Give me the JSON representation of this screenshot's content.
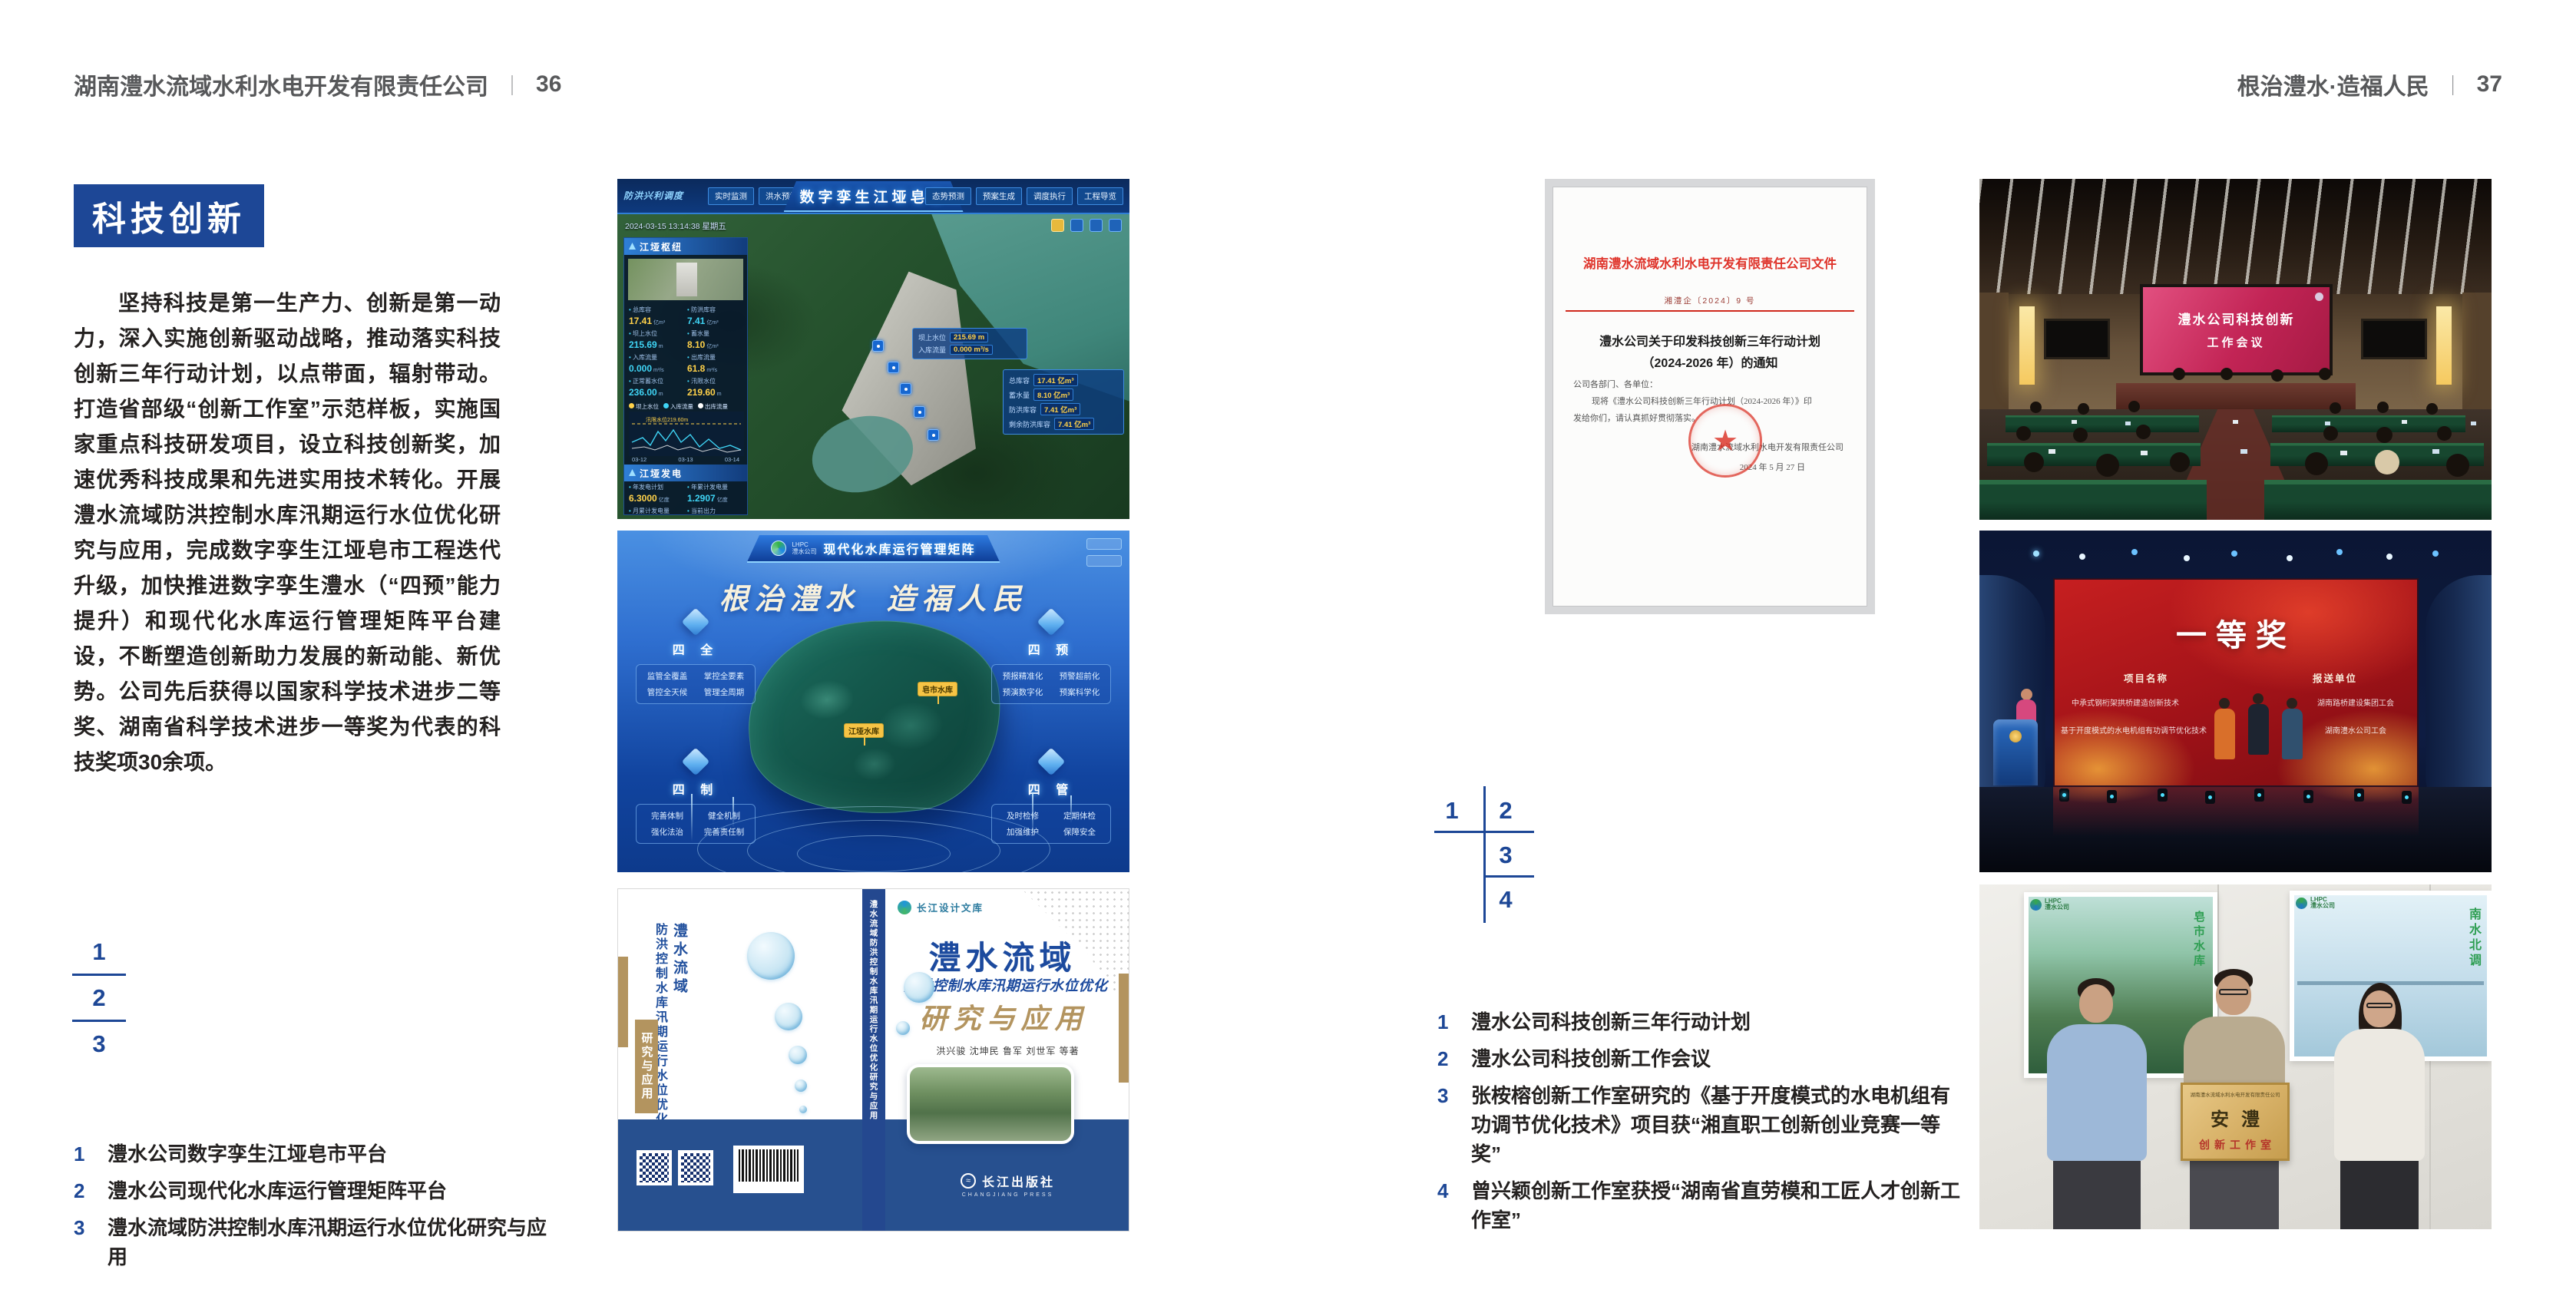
{
  "colors": {
    "accent_blue": "#1d4796",
    "text_dark": "#242120",
    "header_gray": "#57585a",
    "doc_red": "#df342b",
    "tan": "#b3945f"
  },
  "left_page": {
    "header_company": "湖南澧水流域水利水电开发有限责任公司",
    "header_sep": "｜",
    "header_page": "36",
    "section_title": "科技创新",
    "body_text": "坚持科技是第一生产力、创新是第一动力，深入实施创新驱动战略，推动落实科技创新三年行动计划，以点带面，辐射带动。打造省部级“创新工作室”示范样板，实施国家重点科技研发项目，设立科技创新奖，加速优秀科技成果和先进实用技术转化。开展澧水流域防洪控制水库汛期运行水位优化研究与应用，完成数字孪生江垭皂市工程迭代升级，加快推进数字孪生澧水（“四预”能力提升）和现代化水库运行管理矩阵平台建设，不断塑造创新助力发展的新动能、新优势。公司先后获得以国家科学技术进步二等奖、湖南省科学技术进步一等奖为代表的科技奖项30余项。",
    "key_numbers": [
      "1",
      "2",
      "3"
    ],
    "captions": [
      {
        "no": "1",
        "text": "澧水公司数字孪生江垭皂市平台"
      },
      {
        "no": "2",
        "text": "澧水公司现代化水库运行管理矩阵平台"
      },
      {
        "no": "3",
        "text": "澧水流域防洪控制水库汛期运行水位优化研究与应用"
      }
    ]
  },
  "right_page": {
    "header_slogan": "根治澧水·造福人民",
    "header_sep": "｜",
    "header_page": "37",
    "key_numbers": [
      "1",
      "2",
      "3",
      "4"
    ],
    "captions": [
      {
        "no": "1",
        "text": "澧水公司科技创新三年行动计划"
      },
      {
        "no": "2",
        "text": "澧水公司科技创新工作会议"
      },
      {
        "no": "3",
        "text": "张桉榕创新工作室研究的《基于开度模式的水电机组有功调节优化技术》项目获“湘直职工创新创业竞赛一等奖”"
      },
      {
        "no": "4",
        "text": "曾兴颖创新工作室获授“湖南省直劳模和工匠人才创新工作室”"
      }
    ]
  },
  "dashboard": {
    "title": "数字孪生江垭皂市",
    "corner_tab": "防洪兴利调度",
    "tabs_left": [
      "实时监测",
      "洪水预报",
      "防洪预警"
    ],
    "tabs_right": [
      "态势预测",
      "预案生成",
      "调度执行",
      "工程导览"
    ],
    "timestamp": "2024-03-15 13:14:38 星期五",
    "hub_panel_title": "江垭枢纽",
    "stats": [
      {
        "label": "总库容",
        "value": "17.41",
        "unit": "亿m³"
      },
      {
        "label": "防洪库容",
        "value": "7.41",
        "unit": "亿m³"
      },
      {
        "label": "坝上水位",
        "value": "215.69",
        "unit": "m"
      },
      {
        "label": "蓄水量",
        "value": "8.10",
        "unit": "亿m³"
      },
      {
        "label": "入库流量",
        "value": "0.000",
        "unit": "m³/s"
      },
      {
        "label": "出库流量",
        "value": "61.8",
        "unit": "m³/s"
      },
      {
        "label": "正常蓄水位",
        "value": "236.00",
        "unit": "m"
      },
      {
        "label": "汛限水位",
        "value": "219.60",
        "unit": "m"
      }
    ],
    "chart_legend": [
      "坝上水位",
      "入库流量",
      "出库流量"
    ],
    "chart_note": "汛限水位219.60m",
    "chart_x": [
      "03-12",
      "03-13",
      "03-14"
    ],
    "power_panel_title": "江垭发电",
    "power_stats": [
      {
        "label": "年发电计划",
        "value": "6.3000",
        "unit": "亿度"
      },
      {
        "label": "年累计发电量",
        "value": "1.2907",
        "unit": "亿度"
      },
      {
        "label": "月累计发电量",
        "value": "3359.21",
        "unit": "万度"
      },
      {
        "label": "当前出力",
        "value": "0.00",
        "unit": "MW"
      }
    ],
    "units": [
      "1#机组",
      "2#机组",
      "3#机组"
    ],
    "bubble1": [
      {
        "label": "坝上水位",
        "value": "215.69 m"
      },
      {
        "label": "入库流量",
        "value": "0.000 m³/s"
      }
    ],
    "bubble2": [
      {
        "label": "总库容",
        "value": "17.41 亿m³"
      },
      {
        "label": "蓄水量",
        "value": "8.10 亿m³"
      },
      {
        "label": "防洪库容",
        "value": "7.41 亿m³"
      },
      {
        "label": "剩余防洪库容",
        "value": "7.41 亿m³"
      }
    ]
  },
  "matrix": {
    "logo_mark": "LHPC",
    "logo_text": "澧水公司",
    "title": "现代化水库运行管理矩阵",
    "slogan_a": "根治澧水",
    "slogan_b": "造福人民",
    "panels": [
      {
        "title": "四 全",
        "items": [
          "监管全覆盖",
          "掌控全要素",
          "管控全天候",
          "管理全周期"
        ]
      },
      {
        "title": "四 预",
        "items": [
          "预报精准化",
          "预警超前化",
          "预演数字化",
          "预案科学化"
        ]
      },
      {
        "title": "四 制",
        "items": [
          "完善体制",
          "健全机制",
          "强化法治",
          "完善责任制"
        ]
      },
      {
        "title": "四 管",
        "items": [
          "及时检修",
          "定期体检",
          "加强维护",
          "保障安全"
        ]
      }
    ],
    "map_labels": [
      "江垭水库",
      "皂市水库"
    ]
  },
  "book": {
    "series": "长江设计文库",
    "title": "澧水流域",
    "subtitle": "防洪控制水库汛期运行水位优化",
    "subtitle2": "研究与应用",
    "authors": "洪兴骏  沈坤民  鲁军  刘世军  等著",
    "publisher": "长江出版社",
    "publisher_en": "CHANGJIANG PRESS",
    "publisher_mark": "≈",
    "spine_title": "澧水流域防洪控制水库汛期运行水位优化研究与应用",
    "back_title_1": "澧水流域",
    "back_title_2": "防洪控制水库汛期运行水位优化",
    "back_tag": "研究与应用"
  },
  "document": {
    "header": "湖南澧水流域水利水电开发有限责任公司文件",
    "doc_no": "湘澧企〔2024〕9 号",
    "title_line1": "澧水公司关于印发科技创新三年行动计划",
    "title_line2": "（2024-2026 年）的通知",
    "salutation": "公司各部门、各单位：",
    "body_line1": "现将《澧水公司科技创新三年行动计划（2024-2026 年）》印",
    "body_line2": "发给你们，请认真抓好贯彻落实。",
    "signer": "湖南澧水流域水利水电开发有限责任公司",
    "date": "2024 年 5 月 27 日",
    "stamp_star": "★"
  },
  "meeting": {
    "screen_line1": "澧水公司科技创新",
    "screen_line2": "工作会议"
  },
  "award": {
    "title": "一等奖",
    "col_project": "项目名称",
    "col_unit": "报送单位",
    "rows": [
      {
        "project": "中承式钢桁架拱桥建造创新技术",
        "unit": "湖南路桥建设集团工会"
      },
      {
        "project": "基于开度模式的水电机组有功调节优化技术",
        "unit": "湖南澧水公司工会"
      }
    ]
  },
  "plaque": {
    "header": "湖南澧水流域水利水电开发有限责任公司",
    "name": "安澧",
    "subtitle": "创新工作室",
    "logo_mark": "LHPC",
    "logo_text": "澧水公司",
    "poster_left_text": "皂市水库",
    "poster_right_text": "南水北调"
  }
}
